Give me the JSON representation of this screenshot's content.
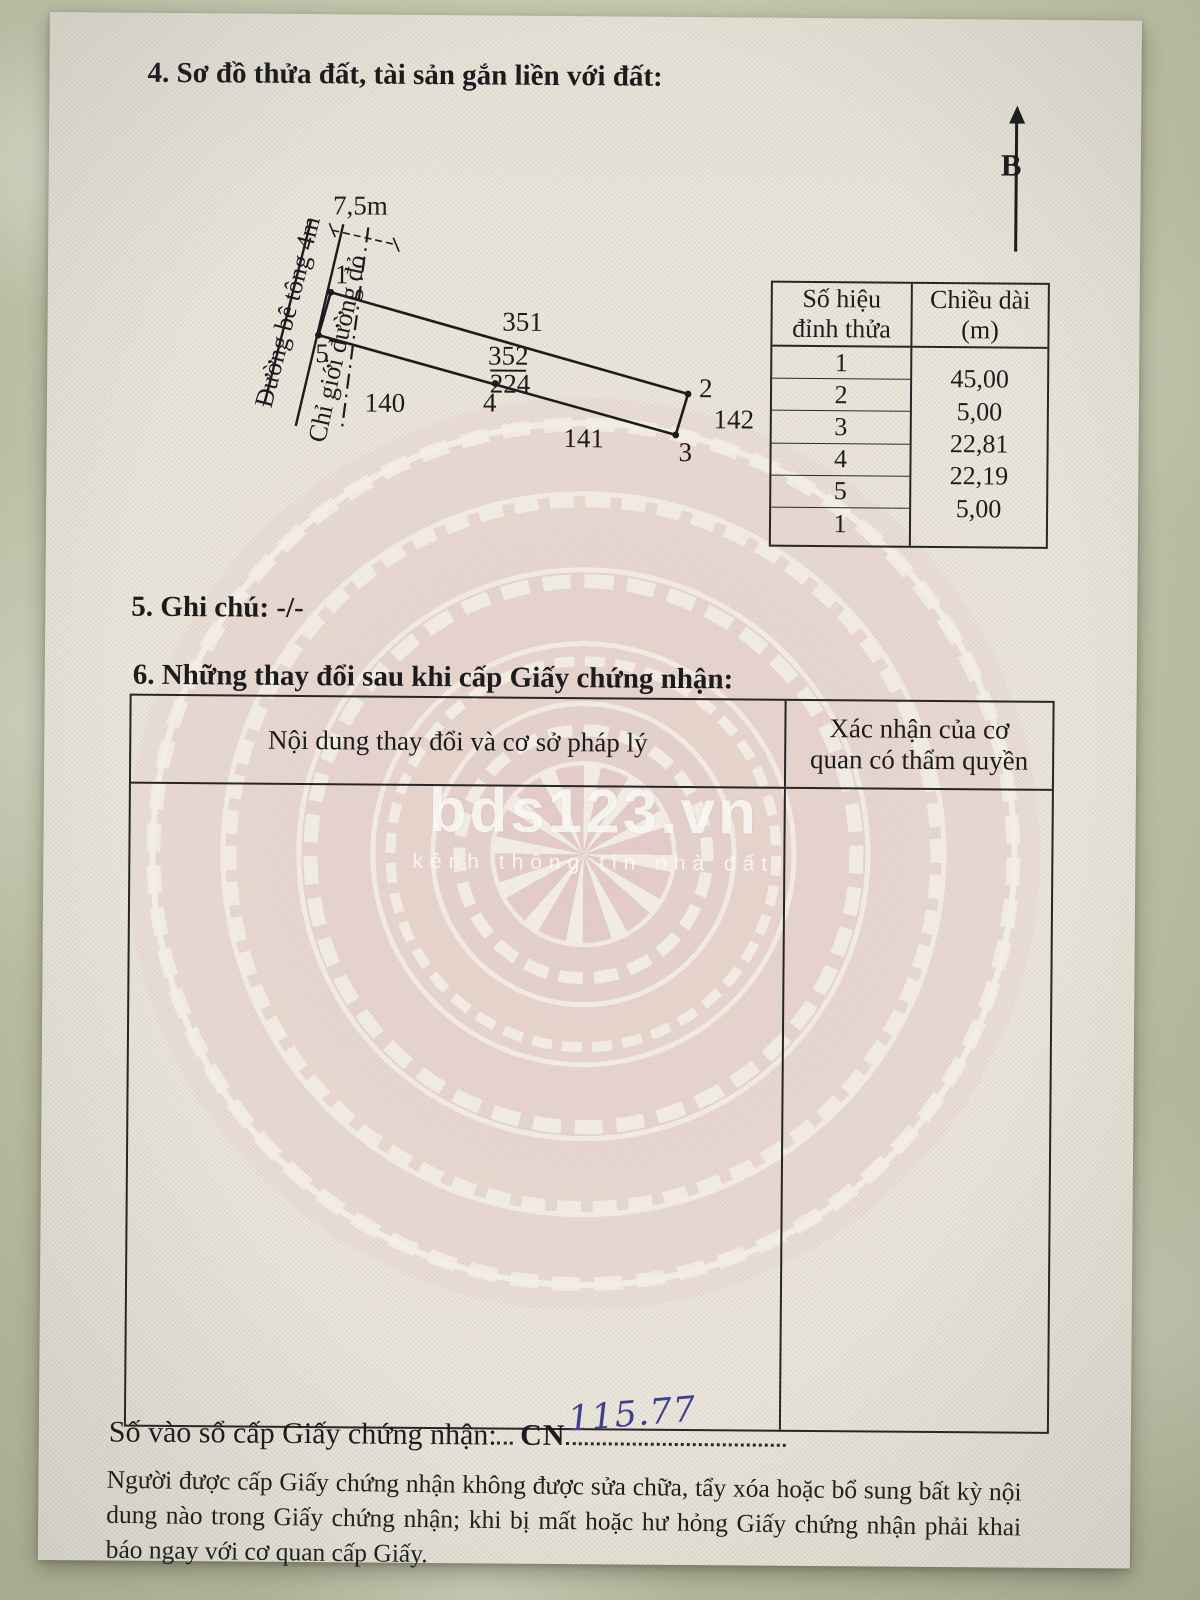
{
  "page": {
    "section4_title": "4. Sơ đồ thửa đất, tài sản gắn liền với đất:",
    "north_label": "B",
    "section5_label": "5. Ghi chú:",
    "section5_value": "-/-",
    "section6_title": "6. Những thay đổi sau khi cấp Giấy chứng nhận:",
    "registry_label": "Số vào sổ cấp Giấy chứng nhận:",
    "registry_prefix": "CN",
    "registry_number": "115.77",
    "footer_note": "Người được cấp Giấy chứng nhận không được sửa chữa, tẩy xóa hoặc bổ sung bất kỳ nội dung nào trong Giấy chứng nhận; khi bị mất hoặc hư hỏng Giấy chứng nhận phải khai báo ngay với cơ quan cấp Giấy."
  },
  "diagram": {
    "road_label": "Đường bê tông 4m",
    "red_line_label": "Chỉ giới đường đỏ",
    "width_dim": "7,5m",
    "parcel_number": "352",
    "parcel_area": "224",
    "adjacent_top": "351",
    "adjacent_left": "140",
    "adjacent_bottom": "141",
    "adjacent_right": "142",
    "vertex_labels": [
      "1",
      "2",
      "3",
      "4",
      "5"
    ]
  },
  "plot_table": {
    "header_col1": "Số hiệu đỉnh thửa",
    "header_col2": "Chiều dài (m)",
    "vertex_numbers": [
      "1",
      "2",
      "3",
      "4",
      "5",
      "1"
    ],
    "lengths": [
      "45,00",
      "5,00",
      "22,81",
      "22,19",
      "5,00"
    ]
  },
  "changes_table": {
    "header_col1": "Nội dung thay đổi và cơ sở pháp lý",
    "header_col2": "Xác nhận của cơ quan có thẩm quyền"
  },
  "watermark": {
    "brand": "bds123.vn",
    "tagline": "kênh thông tin nhà đất"
  },
  "colors": {
    "ink": "#1c1c1e",
    "paper": "#ebe7dc",
    "drum_pink": "#e2c7c4",
    "handwriting_blue": "#3f418f",
    "background_surface": "#bdc1a6",
    "watermark_white": "#fcfcf9"
  }
}
